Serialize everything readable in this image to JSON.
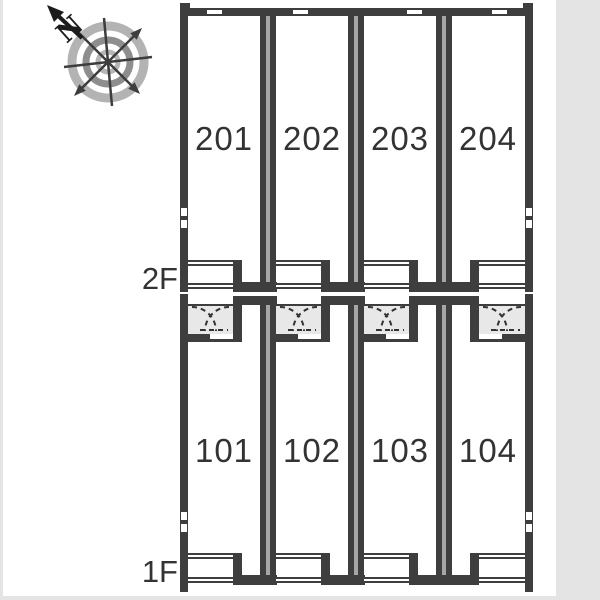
{
  "compass": {
    "icon": "compass-rose-icon",
    "north_label": "N"
  },
  "floors": [
    {
      "label": "2F",
      "units": [
        "201",
        "202",
        "203",
        "204"
      ]
    },
    {
      "label": "1F",
      "units": [
        "101",
        "102",
        "103",
        "104"
      ]
    }
  ],
  "colors": {
    "wall": "#3e3e3e",
    "divider_core": "#a6a6a6",
    "porch": "#e8e8e8",
    "page_margin": "#e4e4e4",
    "label_text": "#333333",
    "canvas": "#ffffff"
  }
}
